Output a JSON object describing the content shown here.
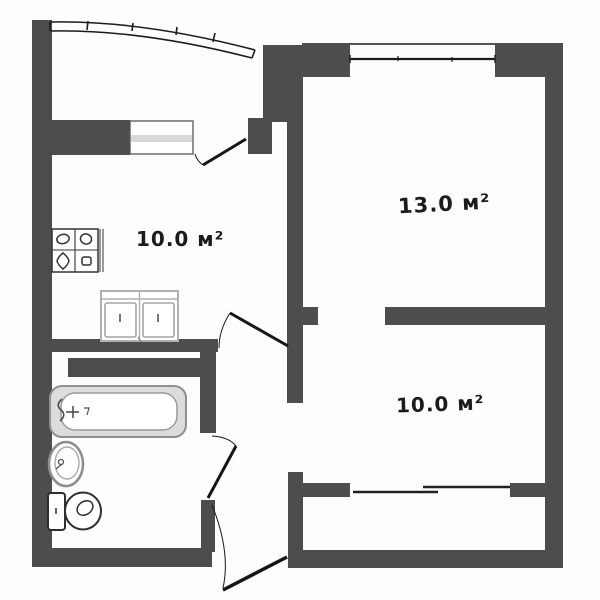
{
  "plan_title": "apartment-floor-plan",
  "rooms": {
    "kitchen": {
      "area_label": "10.0 м²"
    },
    "living_room": {
      "area_label": "13.0 м²"
    },
    "bedroom": {
      "area_label": "10.0 м²"
    }
  },
  "fixtures": {
    "icons": [
      "stove-icon",
      "kitchen-sink-cabinet-icon",
      "bathtub-icon",
      "washbasin-icon",
      "toilet-icon"
    ],
    "doors": [
      "balcony-door",
      "kitchen-door",
      "bathroom-door",
      "entrance-door",
      "wardrobe-sliding-door"
    ],
    "windows": [
      "balcony-glazing",
      "kitchen-window",
      "living-room-window"
    ]
  },
  "colors": {
    "wall": "#4d4d4d",
    "line": "#1c1c1c",
    "fixture_stroke": "#8f8f8f",
    "sill": "#d8d8d8",
    "background": "#ffffff"
  }
}
